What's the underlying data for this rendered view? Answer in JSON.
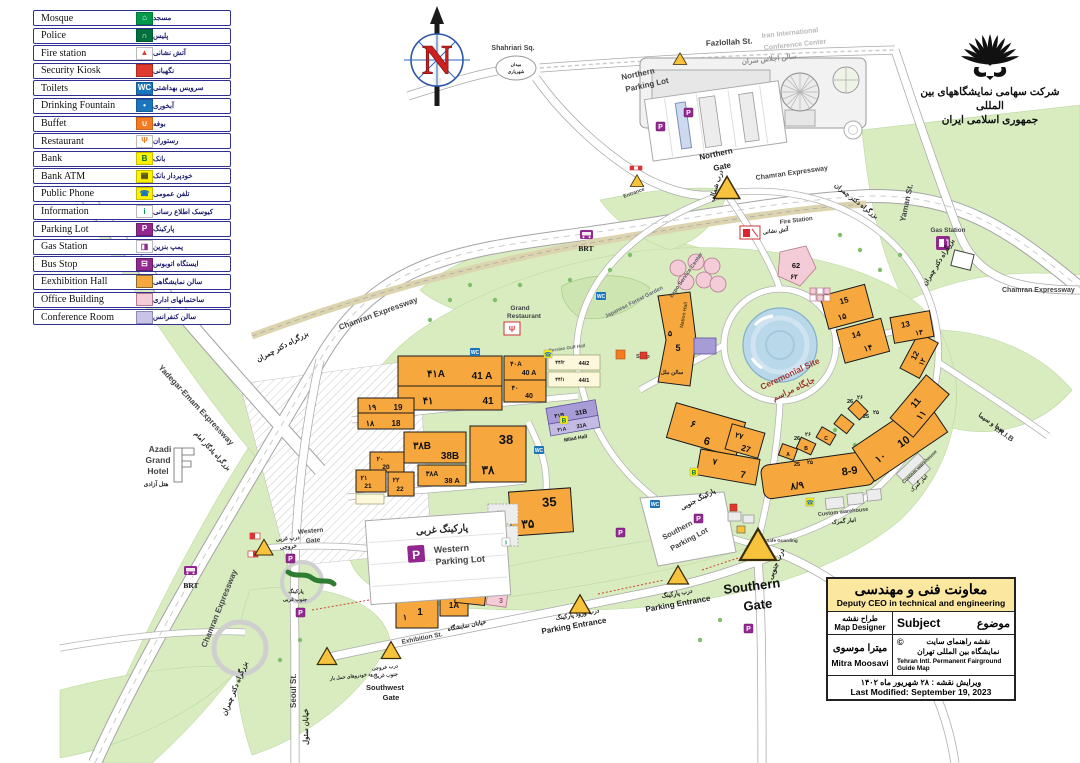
{
  "legend": {
    "items": [
      {
        "name": "mosque",
        "en": "Mosque",
        "fa": "مسجد",
        "glyph": "⌂",
        "bg": "#009949",
        "fg": "#ffffff",
        "bd": "#007a3a"
      },
      {
        "name": "police",
        "en": "Police",
        "fa": "پلیس",
        "glyph": "∩",
        "bg": "#00703c",
        "fg": "#ffffff",
        "bd": "#005a30"
      },
      {
        "name": "fire-station",
        "en": "Fire station",
        "fa": "آتش نشانی",
        "glyph": "▲",
        "bg": "#ffffff",
        "fg": "#e03a2f",
        "bd": "#bbbbbb"
      },
      {
        "name": "security-kiosk",
        "en": "Security Kiosk",
        "fa": "نگهبانی",
        "glyph": "",
        "bg": "#e03a2f",
        "fg": "#ffffff",
        "bd": "#b02a22"
      },
      {
        "name": "toilets",
        "en": "Toilets",
        "fa": "سرویس بهداشتی",
        "glyph": "WC",
        "bg": "#1b75bc",
        "fg": "#ffffff",
        "bd": "#155d96"
      },
      {
        "name": "drinking-fountain",
        "en": "Drinking Fountain",
        "fa": "آبخوری",
        "glyph": "•",
        "bg": "#1b75bc",
        "fg": "#ffffff",
        "bd": "#155d96"
      },
      {
        "name": "buffet",
        "en": "Buffet",
        "fa": "بوفه",
        "glyph": "∪",
        "bg": "#f47b20",
        "fg": "#ffffff",
        "bd": "#c96416"
      },
      {
        "name": "restaurant",
        "en": "Restaurant",
        "fa": "رستوران",
        "glyph": "Ψ",
        "bg": "#ffffff",
        "fg": "#f47b20",
        "bd": "#bbbbbb"
      },
      {
        "name": "bank",
        "en": "Bank",
        "fa": "بانک",
        "glyph": "B",
        "bg": "#fff200",
        "fg": "#00703c",
        "bd": "#c8bd00"
      },
      {
        "name": "bank-atm",
        "en": "Bank ATM",
        "fa": "خودپرداز بانک",
        "glyph": "▤",
        "bg": "#fff200",
        "fg": "#222222",
        "bd": "#c8bd00"
      },
      {
        "name": "public-phone",
        "en": "Public Phone",
        "fa": "تلفن عمومی",
        "glyph": "☎",
        "bg": "#fff200",
        "fg": "#1b75bc",
        "bd": "#c8bd00"
      },
      {
        "name": "information",
        "en": "Information",
        "fa": "کیوسک اطلاع رسانی",
        "glyph": "i",
        "bg": "#ffffff",
        "fg": "#009949",
        "bd": "#bbbbbb"
      },
      {
        "name": "parking-lot",
        "en": "Parking Lot",
        "fa": "پارکینگ",
        "glyph": "P",
        "bg": "#92278f",
        "fg": "#ffffff",
        "bd": "#6b1d69"
      },
      {
        "name": "gas-station",
        "en": "Gas Station",
        "fa": "پمپ بنزین",
        "glyph": "◨",
        "bg": "#ffffff",
        "fg": "#92278f",
        "bd": "#bbbbbb"
      },
      {
        "name": "bus-stop",
        "en": "Bus Stop",
        "fa": "ایستگاه اتوبوس",
        "glyph": "⊟",
        "bg": "#92278f",
        "fg": "#ffffff",
        "bd": "#6b1d69"
      },
      {
        "name": "exhibition-hall",
        "en": "Eexhibition Hall",
        "fa": "سالن نمایشگاهی",
        "glyph": "",
        "bg": "#f6a83f",
        "fg": "#222222",
        "bd": "#8a6a2f"
      },
      {
        "name": "office-building",
        "en": "Office Building",
        "fa": "ساختمانهای اداری",
        "glyph": "",
        "bg": "#f3ccd8",
        "fg": "#222222",
        "bd": "#b5798f"
      },
      {
        "name": "conference-room",
        "en": "Conference Room",
        "fa": "سالن کنفرانس",
        "glyph": "",
        "bg": "#c9c4e6",
        "fg": "#222222",
        "bd": "#8f89b8"
      }
    ]
  },
  "logo": {
    "line1": "شرکت سهامی نمایشگاههای بین المللی",
    "line2": "جمهوری اسلامی ایران"
  },
  "compass": {
    "north": "N"
  },
  "info_box": {
    "title_fa": "معاونت فنی و مهندسی",
    "title_en": "Deputy CEO in technical and engineering",
    "designer_fa": "طراح نقشه",
    "designer_en": "Map Designer",
    "subject_en": "Subject",
    "subject_fa": "موضوع",
    "designer_name_fa": "میترا موسوی",
    "designer_name_en": "Mitra Moosavi",
    "copyright": "©",
    "subject_value_fa1": "نقشه راهنمای سایت",
    "subject_value_fa2": "نمایشگاه بین المللی تهران",
    "subject_value_en": "Tehran Intl. Permanent Fairground Guide Map",
    "modified_fa": "ویرایش نقشه : ۲۸ شهریور ماه ۱۴۰۲",
    "modified_en": "Last Modified: September 19, 2023"
  },
  "map": {
    "streets": {
      "fazlollah": "Fazlollah St.",
      "yaman": "Yaman St.",
      "chamran": "Chamran Expressway",
      "chamran_fa": "بزرگراه دکتر چمران",
      "yadegar": "Yadegar-Emam Expressway",
      "yadegar_fa": "بزرگراه یادگار امام",
      "seoul": "Seoul St.",
      "seoul_fa": "خیابان سئول",
      "exhibition": "Exhibition St.",
      "exhibition_fa": "خیابان نمایشگاه",
      "irib": "I.R.I.B",
      "irib_fa": "صدا و سیما",
      "brt": "BRT"
    },
    "places": {
      "shahriari": "Shahriari Sq.",
      "shahriari_fa1": "میدان",
      "shahriari_fa2": "شهریاری",
      "conference1": "Iran International",
      "conference2": "Conference Center",
      "conference_fa": "سالن اجلاس سران",
      "northern_parking1": "Northern",
      "northern_parking2": "Parking Lot",
      "western_parking1": "Western",
      "western_parking2": "Parking Lot",
      "western_parking_fa": "پارکینگ غربی",
      "southern_parking1": "Southern",
      "southern_parking2": "Parking Lot",
      "southern_parking_fa": "پارکینگ جنوبی",
      "sw_parking_fa1": "پارکینگ",
      "sw_parking_fa2": "جنوب غربی",
      "azadi1": "Azadi",
      "azadi2": "Grand",
      "azadi3": "Hotel",
      "azadi_fa": "هتل آزادی",
      "fire_station": "Fire Station",
      "fire_station_fa": "آتش نشانی",
      "gas_station": "Gas Station",
      "grand_restaurant1": "Grand",
      "grand_restaurant2": "Restaurant",
      "japanese_garden": "Japanese Forest Garden",
      "expo_service": "Expo Service Center",
      "ceremonial": "Ceremonial Site",
      "ceremonial_fa": "جایگاه مراسم",
      "nation_hall": "Nation Hall",
      "nation_hall_fa": "سالن ملل",
      "milad_hall": "Milad Hall",
      "persian_gulf_hall": "Persian Gulf Hall",
      "safe_guarding": "Safe Guarding",
      "custom_warehouse": "Custom warehouse",
      "custom_warehouse_fa": "انبار گمرک",
      "shop": "Shop",
      "entrance": "Entrance"
    },
    "gates": {
      "northern1": "Northern",
      "northern2": "Gate",
      "northern_fa": "درب شمالی",
      "southern1": "Southern",
      "southern2": "Gate",
      "southern_fa": "درب جنوبی",
      "western1": "Western",
      "western2": "Gate",
      "western_fa1": "درب غربی",
      "western_fa2": "خروجی",
      "southwest1": "Southwest",
      "southwest2": "Gate",
      "southwest_fa1": "درب خروجی",
      "southwest_fa2": "جنوب غربی",
      "cargo_fa": "ورود خودروهای حمل بار",
      "parking_entrance": "Parking Entrance",
      "parking_entrance_fa": "درب ورود پارکینگ",
      "parking_entrance2_fa": "درب پارکینگ"
    },
    "halls": {
      "h1": {
        "en": "1",
        "fa": "۱"
      },
      "h1a": {
        "en": "1A"
      },
      "h2": {
        "en": "2"
      },
      "h3": {
        "en": "3",
        "fa": "۳"
      },
      "h5": {
        "en": "5",
        "fa": "۵"
      },
      "h6": {
        "en": "6",
        "fa": "۶"
      },
      "h7": {
        "en": "7",
        "fa": "۷"
      },
      "h89": {
        "en": "8-9",
        "fa": "۸/۹"
      },
      "h10": {
        "en": "10",
        "fa": "۱۰"
      },
      "h11": {
        "en": "11",
        "fa": "۱۱"
      },
      "h12": {
        "en": "12",
        "fa": "۱۲"
      },
      "h13": {
        "en": "13",
        "fa": "۱۳"
      },
      "h14": {
        "en": "14",
        "fa": "۱۴"
      },
      "h15": {
        "en": "15",
        "fa": "۱۵"
      },
      "h18": {
        "en": "18",
        "fa": "۱۸"
      },
      "h19": {
        "en": "19",
        "fa": "۱۹"
      },
      "h20": {
        "en": "20",
        "fa": "۲۰"
      },
      "h21": {
        "en": "21",
        "fa": "۲۱"
      },
      "h22": {
        "en": "22",
        "fa": "۲۲"
      },
      "h25": {
        "en": "25",
        "fa": "۲۵"
      },
      "h26": {
        "en": "26",
        "fa": "۲۶"
      },
      "h27": {
        "en": "27",
        "fa": "۲۷"
      },
      "h31a": {
        "en": "31A",
        "fa": "۳۱A"
      },
      "h31b": {
        "en": "31B",
        "fa": "۳۱B"
      },
      "h35": {
        "en": "35",
        "fa": "۳۵"
      },
      "h37": {
        "en": "37"
      },
      "h37a": {
        "en": "37 A",
        "fa": "۳۷A"
      },
      "h38": {
        "en": "38",
        "fa": "۳۸"
      },
      "h38a": {
        "en": "38 A",
        "fa": "۳۸A"
      },
      "h38b": {
        "en": "38B",
        "fa": "۳۸B"
      },
      "h40": {
        "en": "40",
        "fa": "۴۰"
      },
      "h40a": {
        "en": "40 A",
        "fa": "۴۰A"
      },
      "h41": {
        "en": "41",
        "fa": "۴۱"
      },
      "h41a": {
        "en": "41 A",
        "fa": "۴۱A"
      },
      "h44_1": {
        "en": "44/1",
        "fa": "۴۴/۱"
      },
      "h44_2": {
        "en": "44/2",
        "fa": "۴۴/۲"
      },
      "h62": {
        "en": "62",
        "fa": "۶۲"
      },
      "seg_a": "A",
      "seg_b": "B",
      "seg_c": "C"
    }
  }
}
